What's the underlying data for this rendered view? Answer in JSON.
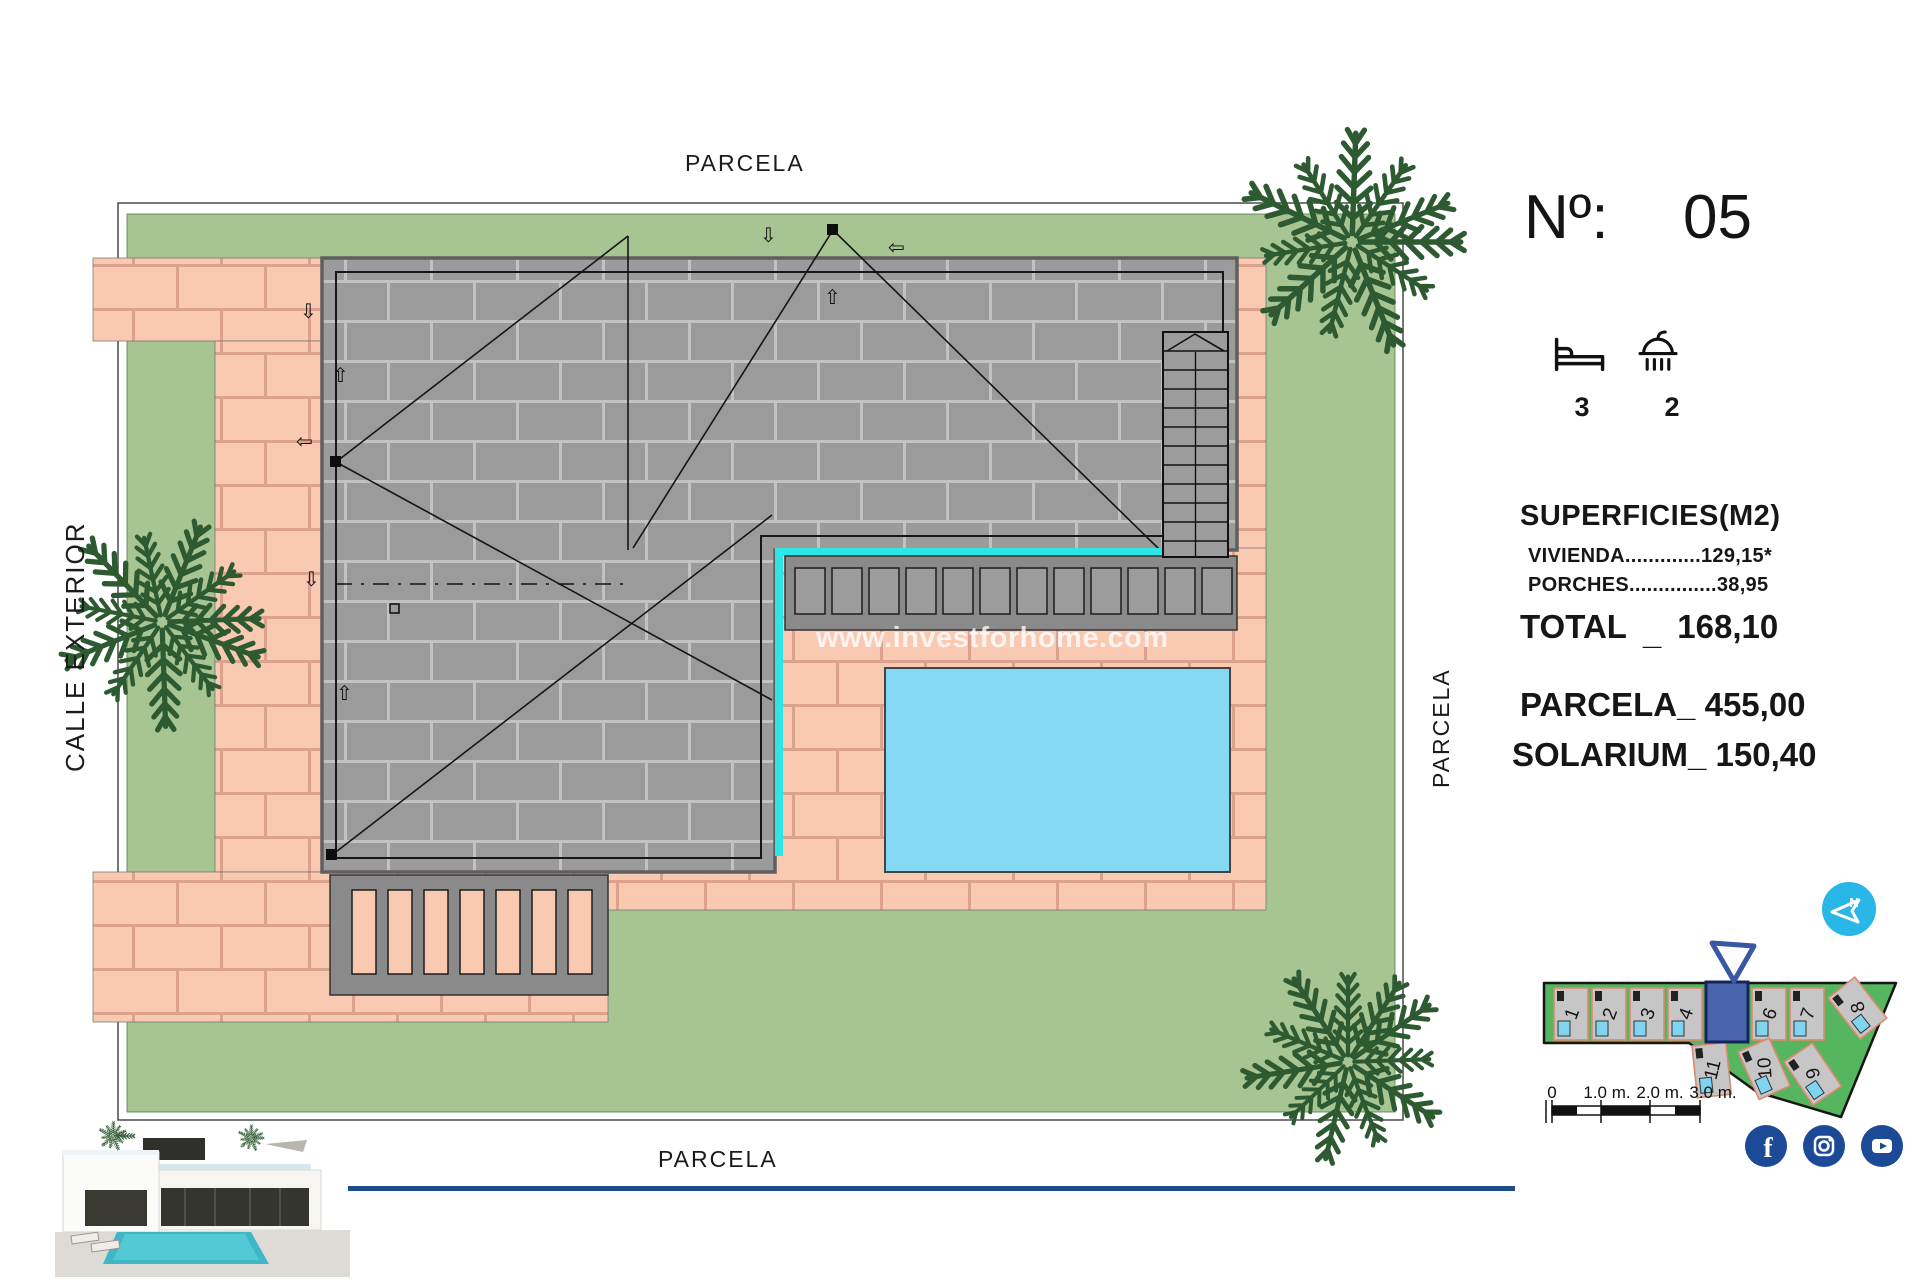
{
  "plan": {
    "label_top": "PARCELA",
    "label_bottom": "PARCELA",
    "label_left": "CALLE EXTERIOR",
    "label_right": "PARCELA",
    "watermark": "www.investforhome.com"
  },
  "info": {
    "number_label": "Nº:",
    "number_value": "05",
    "bedrooms": "3",
    "bathrooms": "2",
    "surfaces_title": "SUPERFICIES(M2)",
    "vivienda_line": "VIVIENDA.............129,15*",
    "porches_line": "PORCHES...............38,95",
    "total_label": "TOTAL",
    "total_sep": "_",
    "total_value": "168,10",
    "parcela_label": "PARCELA_",
    "parcela_value": "455,00",
    "solarium_label": "SOLARIUM_",
    "solarium_value": "150,40"
  },
  "minimap": {
    "plots": [
      "1",
      "2",
      "3",
      "4",
      "6",
      "7",
      "8",
      "11",
      "10",
      "9"
    ],
    "highlighted_plot": "5",
    "scale_labels": [
      "0",
      "1.0 m.",
      "2.0 m.",
      "3.0 m."
    ],
    "compass_letter": "N"
  },
  "icons": [
    "bed-icon",
    "shower-icon",
    "compass-icon",
    "location-triangle-icon",
    "palm-tree-icon",
    "facebook-icon",
    "instagram-icon",
    "youtube-icon"
  ],
  "colors": {
    "grass": "#a7c493",
    "pink": "#f9c9b2",
    "pink_joint": "#dca28e",
    "roof": "#9b9b9b",
    "roof_joint": "#c2c2c2",
    "pool": "#85d9f2",
    "cyan": "#2ee6e6",
    "map_green": "#56b55f",
    "brand_blue": "#1d4a96",
    "compass_blue": "#29b7e8",
    "line_blue": "#1d4e89",
    "palm_green": "#2d5a31",
    "highlight_blue": "#4a63ad"
  }
}
